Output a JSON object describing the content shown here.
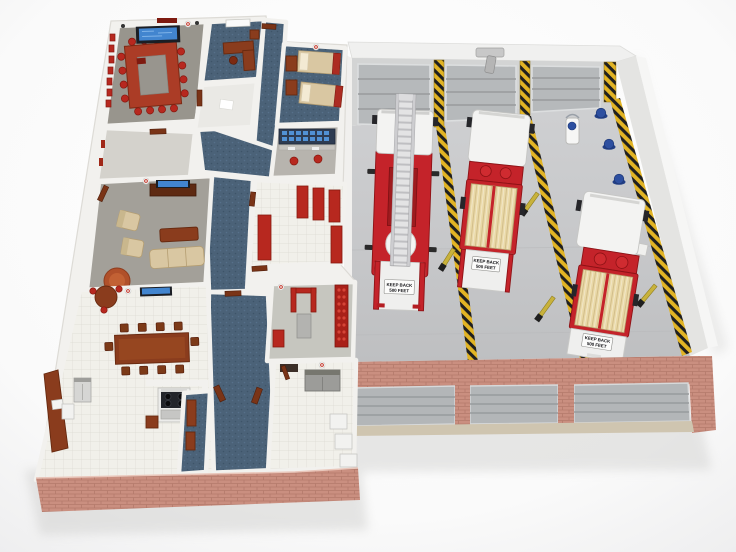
{
  "scene": {
    "title": "fire-station-3d-floorplan-render",
    "view": "top-down cutaway 3D render"
  },
  "palette": {
    "wall": "#f2f1ee",
    "brick": "#ca8f80",
    "brickLine": "#b47a6b",
    "bayFloor": "#c9cacc",
    "hazardYellow": "#e2b424",
    "hazardBlack": "#1f1f1f",
    "truckRed": "#c4232a",
    "hoseTan": "#e9d8a6",
    "carpetBlue": "#4b6278",
    "carpetGray": "#98958d",
    "tile": "#f1f0ea",
    "tileLine": "#dcdbd2",
    "wood": "#8a3c1d",
    "woodDark": "#67290f",
    "chairRed": "#b7281f",
    "tan": "#d9c7a2",
    "screenBlue": "#4285cf",
    "helmetBlue": "#2d4fa0",
    "apron": "#cfc5b0"
  },
  "bay": {
    "rear_sign": {
      "line1": "KEEP BACK",
      "line2": "500 FEET"
    },
    "lanes": 3,
    "garage_doors_rear": 3,
    "garage_doors_front": 3,
    "trucks": [
      {
        "id": "ladder-truck",
        "type": "aerial-ladder-truck"
      },
      {
        "id": "engine-1",
        "type": "pumper-engine"
      },
      {
        "id": "engine-2",
        "type": "pumper-engine"
      }
    ],
    "equipment": {
      "helmets": 3,
      "gurney": 1,
      "exhaust_hose_drops": 4
    }
  },
  "quarters": {
    "rooms": [
      {
        "id": "conference-room"
      },
      {
        "id": "office"
      },
      {
        "id": "storage-room"
      },
      {
        "id": "bunk-room"
      },
      {
        "id": "dispatch-room"
      },
      {
        "id": "sitting-room"
      },
      {
        "id": "lounge"
      },
      {
        "id": "locker-room"
      },
      {
        "id": "gym"
      },
      {
        "id": "kitchen-dining"
      },
      {
        "id": "laundry-room"
      },
      {
        "id": "vestibule"
      }
    ]
  }
}
